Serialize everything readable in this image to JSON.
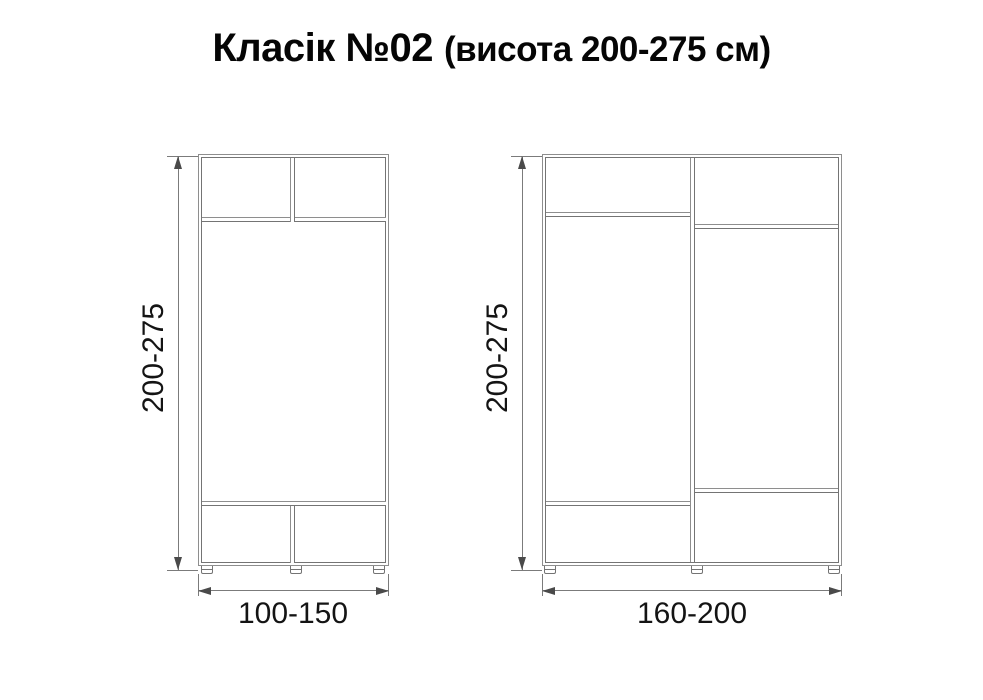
{
  "title": {
    "main": "Класік №02",
    "sub": "(висота 200-275 см)"
  },
  "diagrams": [
    {
      "height_label": "200-275",
      "width_label": "100-150"
    },
    {
      "height_label": "200-275",
      "width_label": "160-200"
    }
  ],
  "colors": {
    "line": "#8e8e8e",
    "line2": "#747474",
    "dim": "#7b7b7b",
    "arrow": "#4a4a4a",
    "text": "#141414",
    "title": "#050505",
    "background": "#ffffff"
  }
}
